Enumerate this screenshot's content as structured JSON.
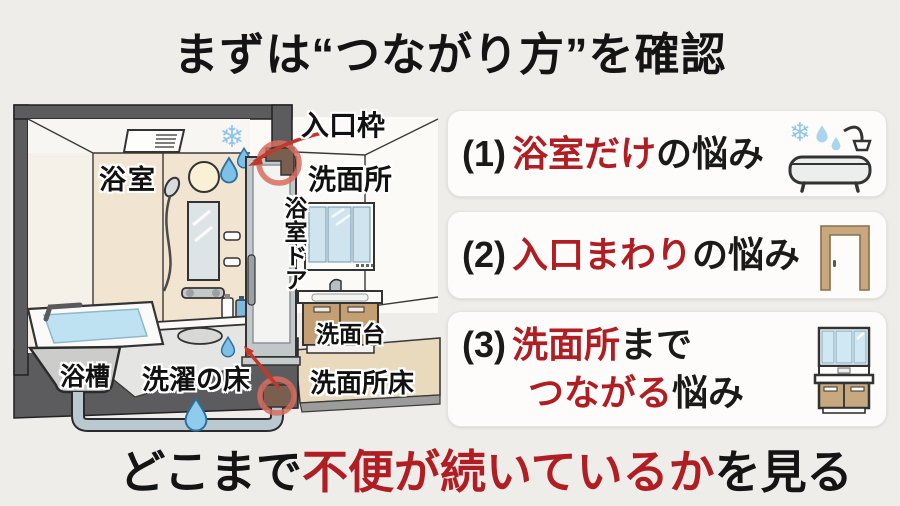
{
  "title": "まずは“つながり方”を確認",
  "diagram": {
    "labels": {
      "bathroom": "浴室",
      "entrance_frame": "入口枠",
      "washroom": "洗面所",
      "bathroom_door": "浴室ドア",
      "vanity": "洗面台",
      "washroom_floor": "洗面所床",
      "washing_floor": "洗濯の床",
      "bathtub": "浴槽"
    },
    "icons": [
      "snowflake-icon",
      "water-drop-icon",
      "highlight-circle-top",
      "highlight-circle-bottom",
      "drain-pipe"
    ]
  },
  "checklist": {
    "item1": {
      "number": "(1)",
      "red": "浴室だけ",
      "black": "の悩み",
      "icon": "bathtub-icon"
    },
    "item2": {
      "number": "(2)",
      "red": "入口まわり",
      "black": "の悩み",
      "icon": "door-frame-icon"
    },
    "item3": {
      "number": "(3)",
      "red1": "洗面所",
      "black1": "まで",
      "red2": "つながる",
      "black2": "悩み",
      "icon": "vanity-icon"
    }
  },
  "footer": {
    "black1": "どこまで",
    "red": "不便が続いているか",
    "black2": "を見る"
  },
  "colors": {
    "background": "#efedea",
    "accent_red_text": "#b01d22",
    "highlight_circle_red": "#d96c5f",
    "arrow_red": "#c0392b",
    "frame_gray": "#5c5c5e",
    "wall_beige": "#f1e4d1",
    "washroom_floor_beige": "#e9dabd",
    "water_blue": "#bfe2f2",
    "drop_blue": "#7fc0e8",
    "cabinet_tan": "#c59f74",
    "mirror_blue": "#cfe4ee"
  }
}
